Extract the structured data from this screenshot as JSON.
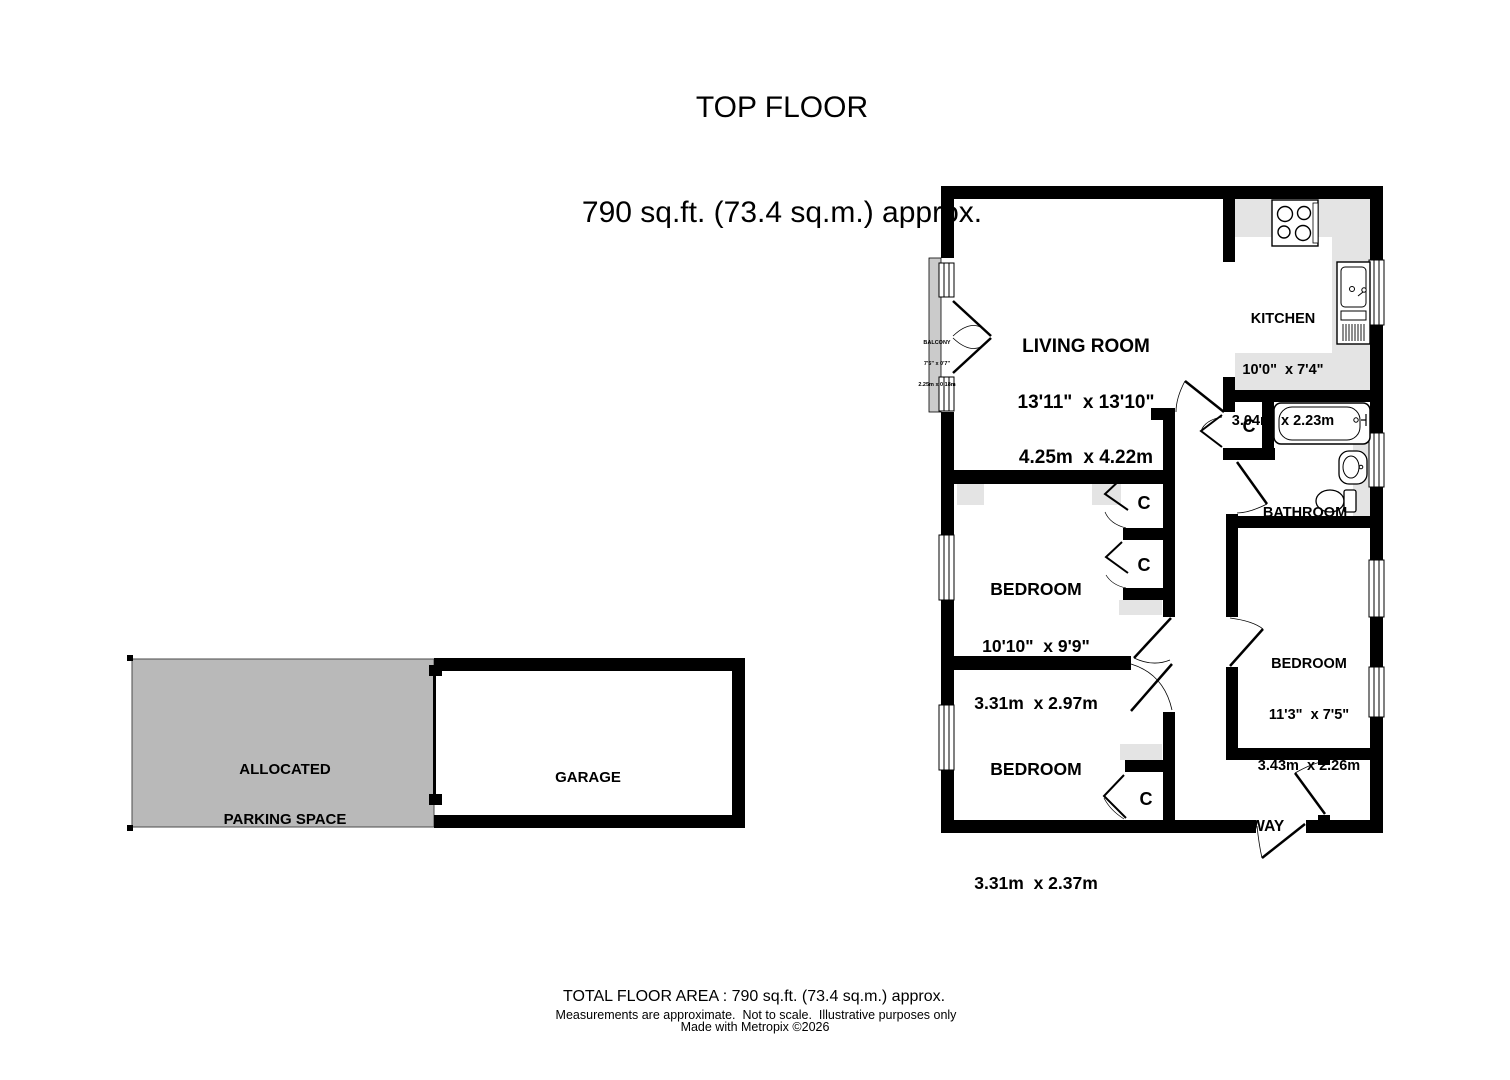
{
  "title": {
    "line1": "TOP FLOOR",
    "line2": "790 sq.ft. (73.4 sq.m.) approx."
  },
  "floor": {
    "living_room": {
      "name": "LIVING ROOM",
      "size_imperial": "13'11\"  x 13'10\"",
      "size_metric": "4.25m  x 4.22m"
    },
    "kitchen": {
      "name": "KITCHEN",
      "size_imperial": "10'0\"  x 7'4\"",
      "size_metric": "3.04m  x 2.23m"
    },
    "balcony": {
      "name": "BALCONY",
      "size_imperial": "7'5\" x 0'7\"",
      "size_metric": "2.25m x 0.18m"
    },
    "bathroom": {
      "name": "BATHROOM"
    },
    "bedroom_middle": {
      "name": "BEDROOM",
      "size_imperial": "10'10\"  x 9'9\"",
      "size_metric": "3.31m  x 2.97m"
    },
    "bedroom_right": {
      "name": "BEDROOM",
      "size_imperial": "11'3\"  x 7'5\"",
      "size_metric": "3.43m  x 2.26m"
    },
    "bedroom_bottom": {
      "name": "BEDROOM",
      "size_imperial": "10'10\"  x 7'9\"",
      "size_metric": "3.31m  x 2.37m"
    },
    "hallway": {
      "name": "HALLWAY"
    },
    "store": {
      "name": "STORE"
    },
    "closet": {
      "label": "C"
    }
  },
  "outbuildings": {
    "parking": {
      "line1": "ALLOCATED",
      "line2": "PARKING SPACE"
    },
    "garage": {
      "name": "GARAGE"
    }
  },
  "footer": {
    "total_area": "TOTAL FLOOR AREA : 790 sq.ft. (73.4 sq.m.) approx.",
    "disclaimer": "Measurements are approximate.  Not to scale.  Illustrative purposes only",
    "credit": "Made with Metropix ©2026"
  },
  "colors": {
    "wall": "#000000",
    "kitchen_floor": "#e4e4e4",
    "parking_fill": "#b9b9b9",
    "balcony_fill": "#cbcbcb",
    "patch_fill": "#e4e4e4"
  }
}
